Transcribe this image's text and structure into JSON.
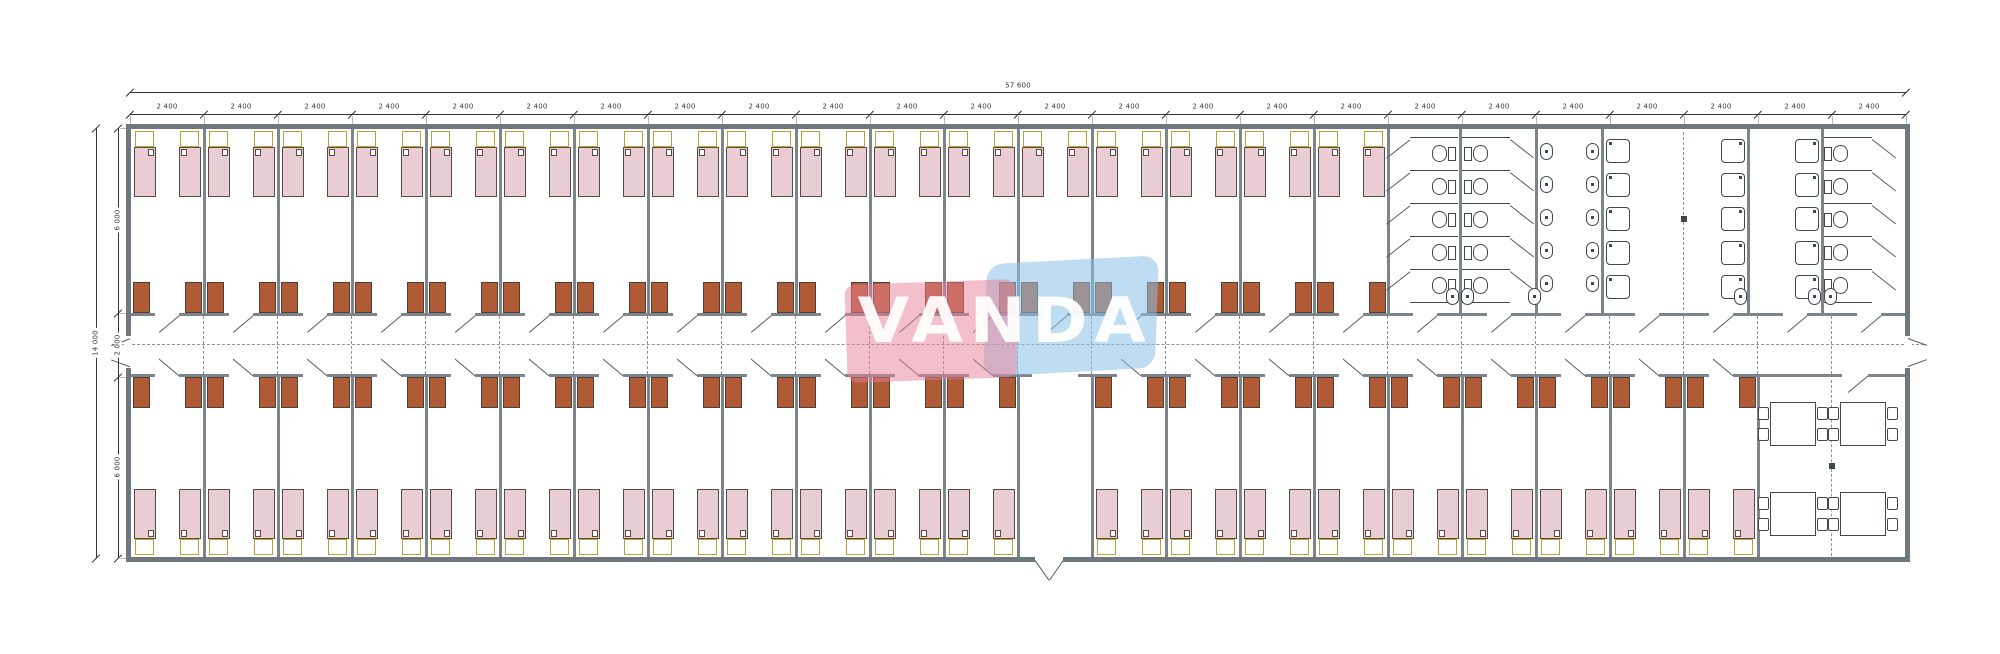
{
  "drawing": {
    "type": "architectural floor plan",
    "watermark_text": "VANDA"
  },
  "dimensions": {
    "top_total_label": "57 600",
    "top_module_label": "2 400",
    "top_module_count": 24,
    "left_total_label": "14 000",
    "left_segment_labels": [
      "6 000",
      "2 000",
      "6 000"
    ]
  },
  "plan": {
    "rooms_top_count": 17,
    "rooms_bottom_count": 22,
    "entrance_module_bottom": 13,
    "beds_per_room": 2,
    "wardrobes_per_room": 2,
    "sanitary": {
      "toilet_stall_rows": 5,
      "corner_toilet_stall_rows": 5,
      "sink_columns": [
        5,
        5
      ],
      "shower_columns": [
        5,
        5,
        5
      ],
      "corridor_end_sinks": [
        2,
        1,
        1,
        2
      ]
    },
    "dining": {
      "tables": 4,
      "chairs_per_table": 4
    }
  },
  "colors": {
    "wall": "#6f777f",
    "partition": "#7c848c",
    "bed_fill": "#e9cdd5",
    "bed_border": "#5a4a41",
    "pillow_border": "#b9a233",
    "wardrobe_fill": "#b15b36",
    "wardrobe_border": "#4e3e34",
    "fixture": "#41474d",
    "line": "#565c62",
    "dim": "#33373c",
    "dash": "#8f9396",
    "watermark_pink": "rgba(231,128,150,0.50)",
    "watermark_blue": "rgba(139,193,232,0.55)",
    "watermark_text": "rgba(255,255,255,0.93)"
  }
}
